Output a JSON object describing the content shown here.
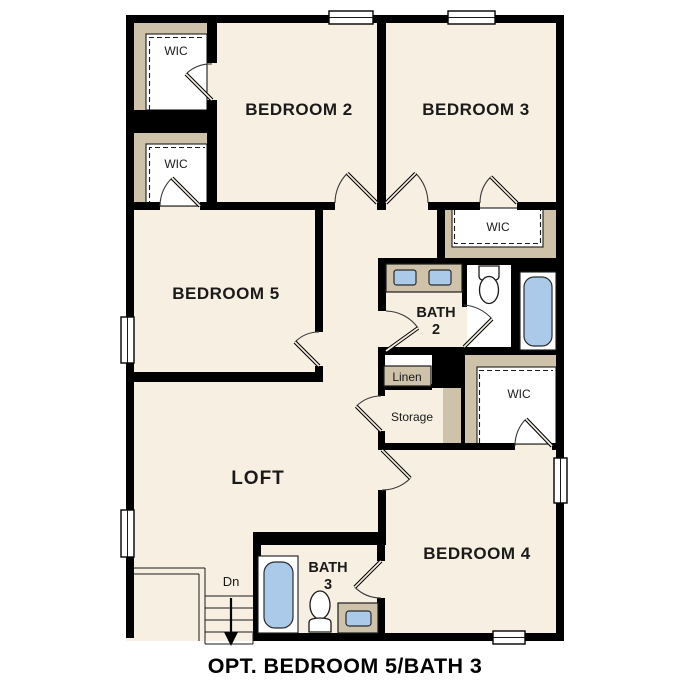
{
  "caption": "OPT. BEDROOM 5/BATH 3",
  "rooms": {
    "bedroom2": "BEDROOM 2",
    "bedroom3": "BEDROOM 3",
    "bedroom5": "BEDROOM 5",
    "bedroom4": "BEDROOM 4",
    "loft": "LOFT",
    "bath2": {
      "line1": "BATH",
      "line2": "2"
    },
    "bath3": {
      "line1": "BATH",
      "line2": "3"
    },
    "wic": "WIC",
    "linen": "Linen",
    "storage": "Storage"
  },
  "stairs": {
    "down_label": "Dn"
  },
  "colors": {
    "background": "#ffffff",
    "floor": "#f6efe2",
    "wall": "#000000",
    "cabinet_tan": "#cec3aa",
    "fixture_blue": "#abc9e9"
  }
}
